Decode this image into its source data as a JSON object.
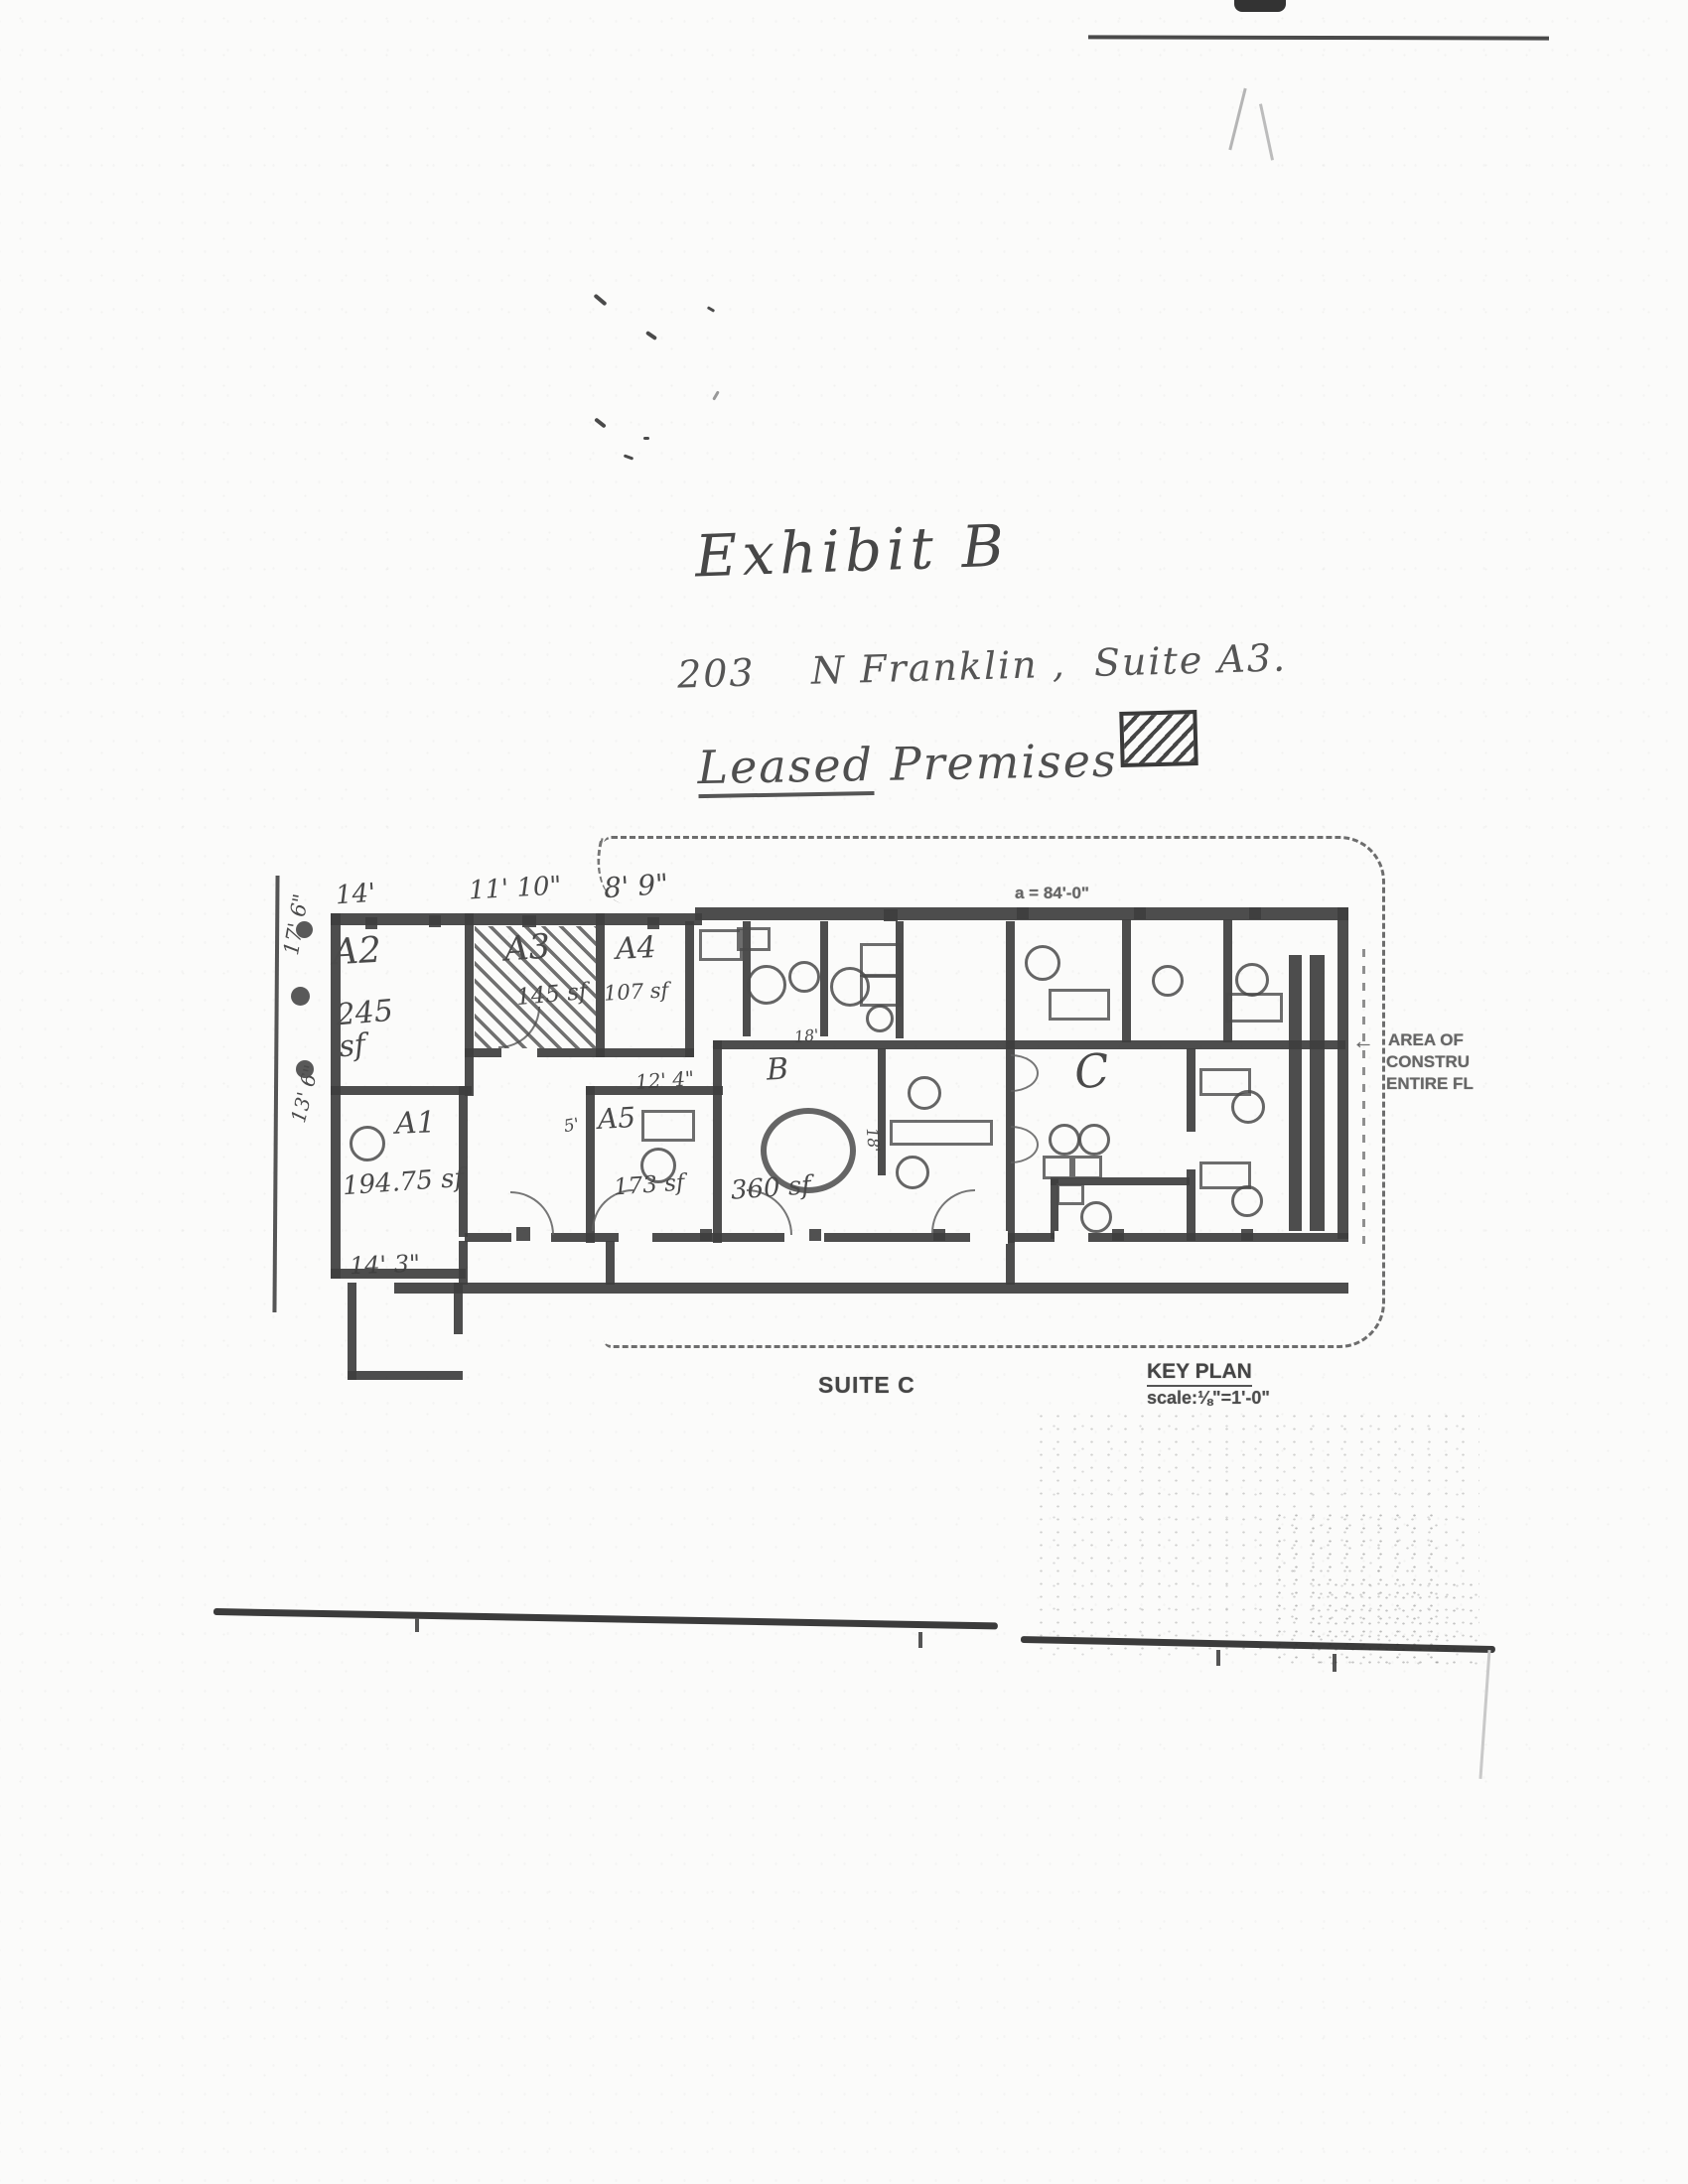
{
  "document": {
    "title": "Exhibit B",
    "address": "203    N Franklin ,  Suite A3.",
    "legend_word_1": "Leased",
    "legend_word_2": " Premises",
    "legend_meaning": "Leased premises shown hatched"
  },
  "plan": {
    "overall_dim": "a = 84'-0\"",
    "dims": {
      "top_a2": "14'",
      "top_a3": "11' 10\"",
      "top_a4": "8' 9\"",
      "left_upper": "17' 6\"",
      "left_lower": "13' 6\"",
      "bottom_a1": "14' 3\"",
      "a5_top": "12' 4\"",
      "a5_left": "5'",
      "b_top": "18'",
      "b_side": "18'"
    },
    "rooms": {
      "a1": {
        "label": "A1",
        "area": "194.75 sf"
      },
      "a2": {
        "label": "A2",
        "area": "245\nsf"
      },
      "a3": {
        "label": "A3",
        "area": "145 sf"
      },
      "a4": {
        "label": "A4",
        "area": "107 sf"
      },
      "a5": {
        "label": "A5",
        "area": "173 sf"
      },
      "b": {
        "label": "B",
        "area": "360 sf"
      },
      "c": {
        "label": "C"
      }
    },
    "captions": {
      "suite": "SUITE C",
      "key_plan": "KEY PLAN",
      "scale": "scale:⅛\"=1'-0\""
    },
    "area_note": {
      "line1": "AREA OF",
      "line2": "CONSTRU",
      "line3": "ENTIRE FL"
    },
    "icons": {
      "left_arrow": "←"
    },
    "colors": {
      "ink": "#3e3e3e",
      "pencil": "#4a4a4a",
      "paper": "#fbfbfa"
    }
  }
}
